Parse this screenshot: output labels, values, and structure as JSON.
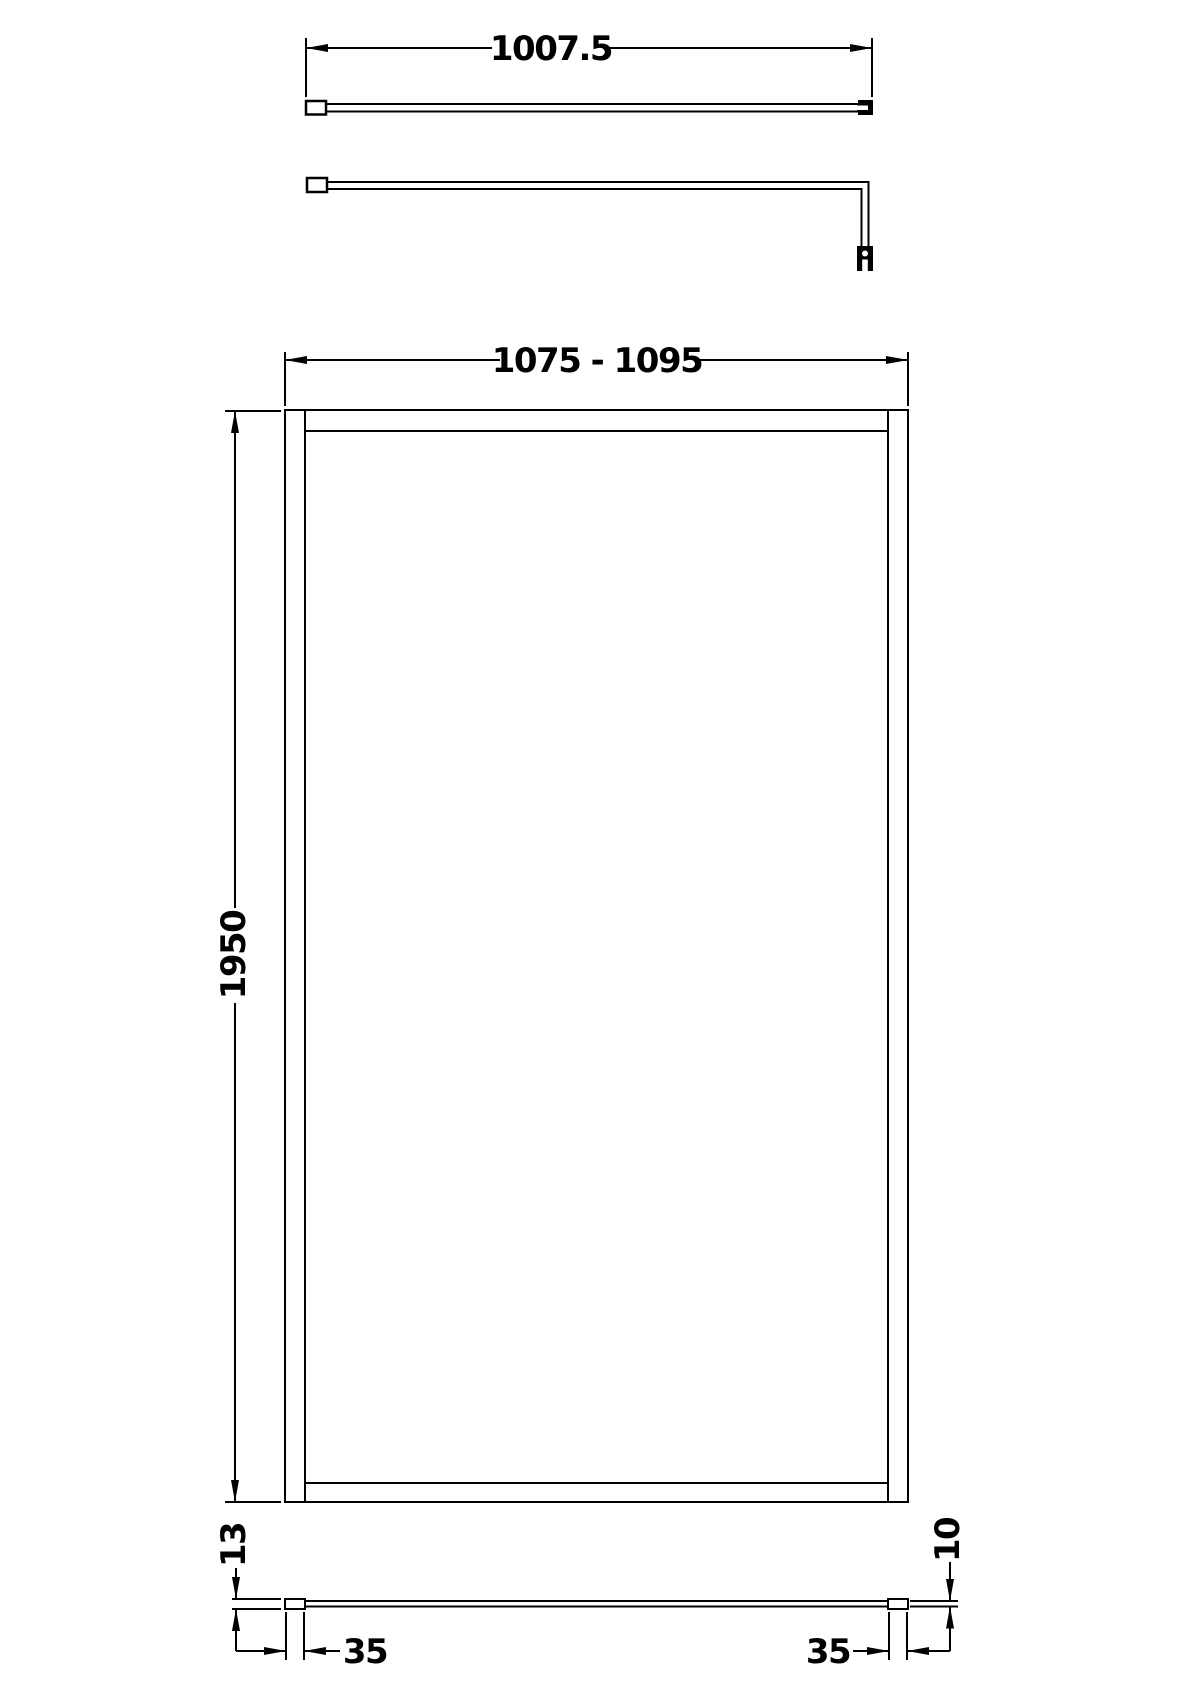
{
  "drawing": {
    "background_color": "#ffffff",
    "line_color": "#000000",
    "support_bar_top_view": {
      "length_label": "1007.5"
    },
    "front_view": {
      "width_label": "1075 - 1095",
      "height_label": "1950"
    },
    "plan_view": {
      "profile_depth_label": "13",
      "glass_thickness_label": "10",
      "profile_width_labels": [
        "35",
        "35"
      ]
    }
  }
}
